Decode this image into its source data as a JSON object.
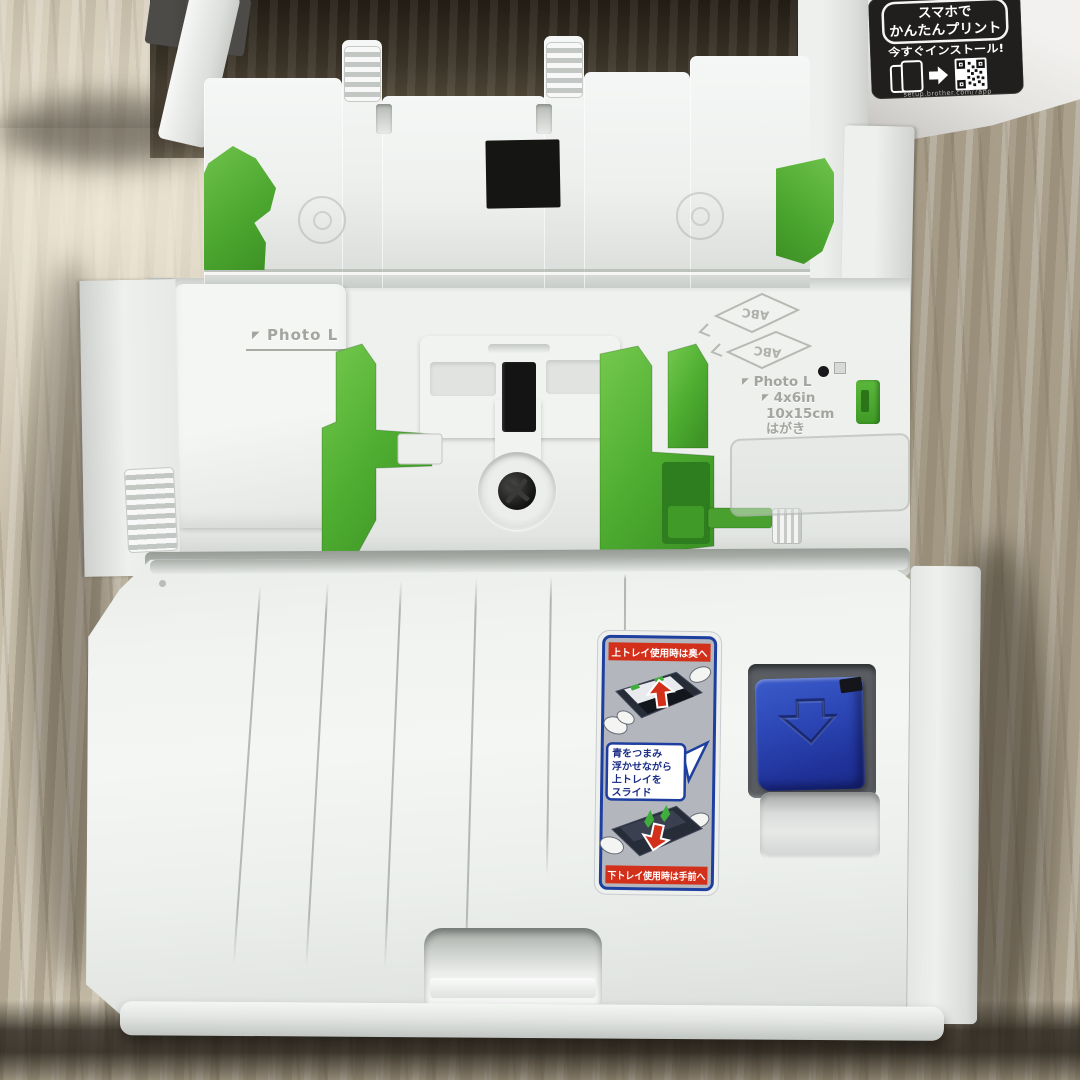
{
  "promo_sticker": {
    "headline_line1": "スマホで",
    "headline_line2": "かんたんプリント",
    "subline": "今すぐインストール!",
    "url": "setup.brother.com/?app"
  },
  "tray_markings": {
    "corner_mark": "◤",
    "upper_guide_label": "Photo L",
    "right_label_photo": "Photo L",
    "right_label_inch": "4x6in",
    "right_label_cm": "10x15cm",
    "right_label_hagaki": "はがき",
    "emboss_abc_1": "ABC",
    "emboss_abc_2": "ABC"
  },
  "instruction_sticker": {
    "top_band": "上トレイ使用時は奥へ",
    "bubble_line1": "青をつまみ",
    "bubble_line2": "浮かせながら",
    "bubble_line3": "上トレイを",
    "bubble_line4": "スライド",
    "bottom_band": "下トレイ使用時は手前へ"
  },
  "colors": {
    "guide_green": "#57b33a",
    "latch_blue": "#2544b2",
    "band_red": "#d3301b",
    "sticker_frame_blue": "#1e3f9f",
    "carpet_beige": "#b7ad99",
    "plastic_white": "#eef0ee"
  }
}
